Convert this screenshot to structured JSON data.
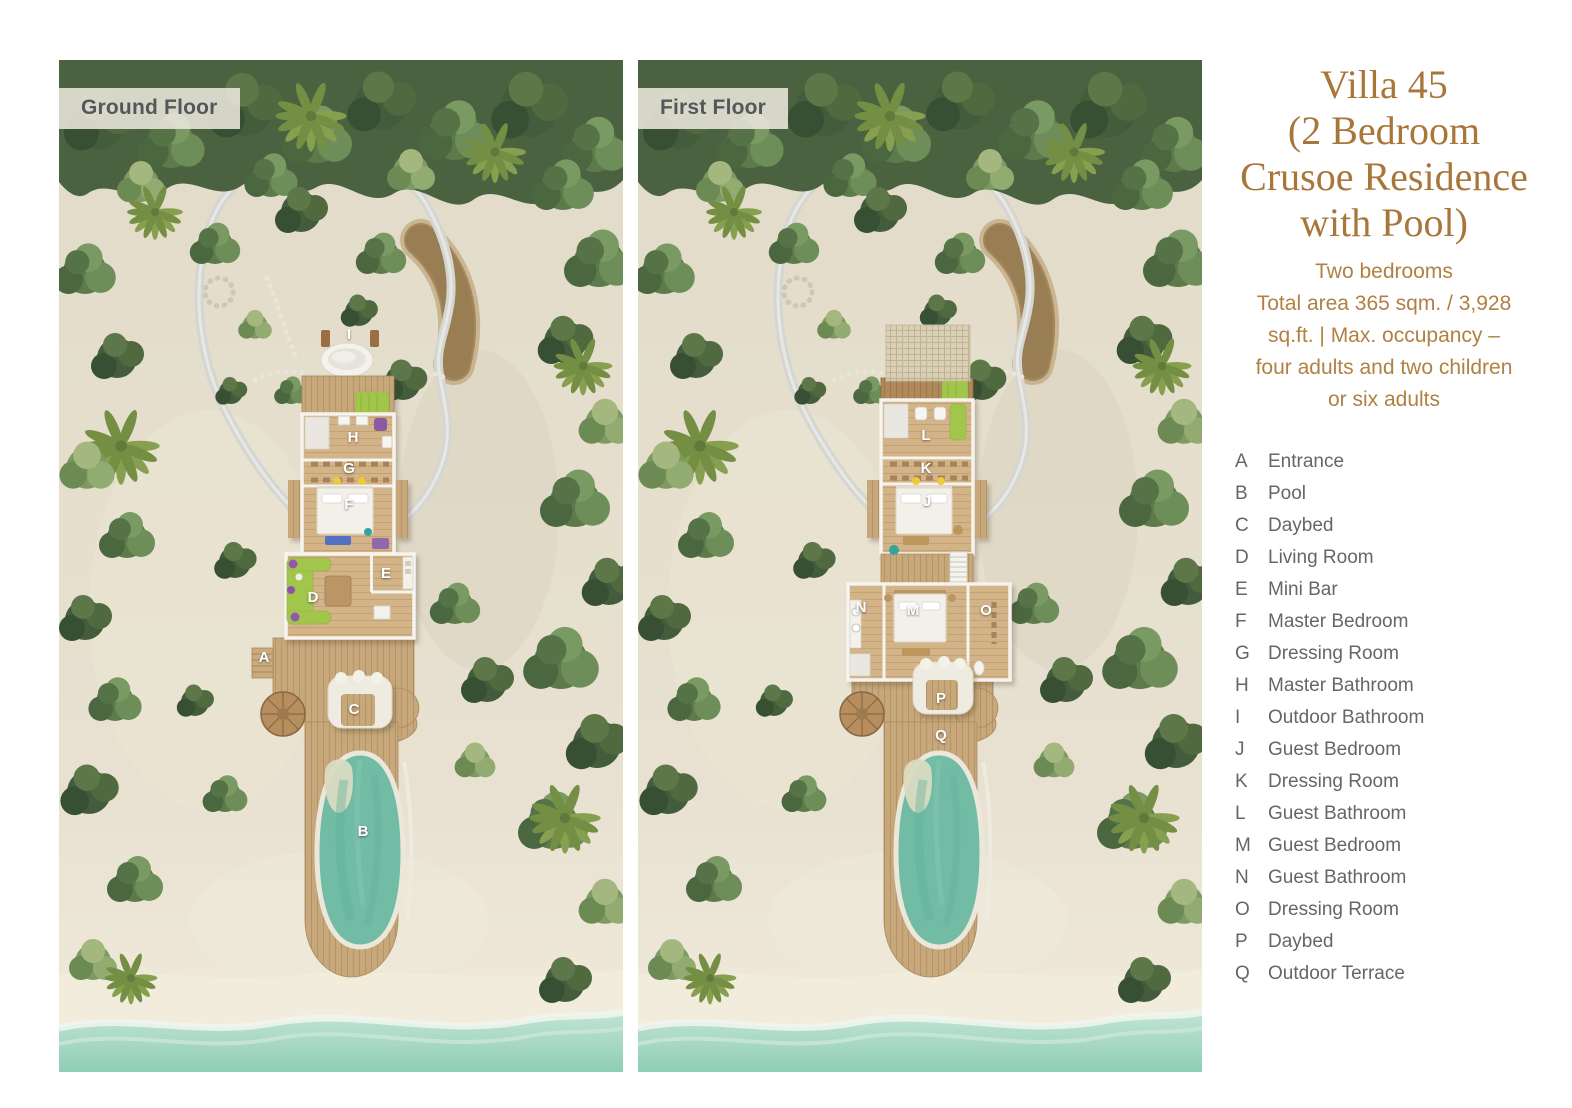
{
  "panels": [
    {
      "floor_label": "Ground Floor",
      "markers": [
        {
          "letter": "I",
          "x": 290,
          "y": 274
        },
        {
          "letter": "H",
          "x": 294,
          "y": 377
        },
        {
          "letter": "G",
          "x": 290,
          "y": 408
        },
        {
          "letter": "F",
          "x": 290,
          "y": 444
        },
        {
          "letter": "E",
          "x": 327,
          "y": 513
        },
        {
          "letter": "D",
          "x": 254,
          "y": 537
        },
        {
          "letter": "A",
          "x": 205,
          "y": 597
        },
        {
          "letter": "C",
          "x": 295,
          "y": 649
        },
        {
          "letter": "B",
          "x": 304,
          "y": 771
        }
      ]
    },
    {
      "floor_label": "First Floor",
      "markers": [
        {
          "letter": "L",
          "x": 288,
          "y": 375
        },
        {
          "letter": "K",
          "x": 288,
          "y": 408
        },
        {
          "letter": "J",
          "x": 289,
          "y": 441
        },
        {
          "letter": "N",
          "x": 223,
          "y": 547
        },
        {
          "letter": "M",
          "x": 275,
          "y": 550
        },
        {
          "letter": "O",
          "x": 348,
          "y": 550
        },
        {
          "letter": "P",
          "x": 303,
          "y": 638
        },
        {
          "letter": "Q",
          "x": 303,
          "y": 675
        }
      ]
    }
  ],
  "sidebar": {
    "title_lines": [
      "Villa 45",
      "(2 Bedroom",
      "Crusoe Residence",
      "with Pool)"
    ],
    "summary_lines": [
      "Two bedrooms",
      "Total area 365 sqm. / 3,928",
      "sq.ft. | Max. occupancy –",
      "four adults and two children",
      "or six adults"
    ],
    "legend": [
      {
        "key": "A",
        "label": "Entrance"
      },
      {
        "key": "B",
        "label": "Pool"
      },
      {
        "key": "C",
        "label": "Daybed"
      },
      {
        "key": "D",
        "label": "Living Room"
      },
      {
        "key": "E",
        "label": "Mini Bar"
      },
      {
        "key": "F",
        "label": "Master Bedroom"
      },
      {
        "key": "G",
        "label": "Dressing Room"
      },
      {
        "key": "H",
        "label": "Master Bathroom"
      },
      {
        "key": "I",
        "label": "Outdoor Bathroom"
      },
      {
        "key": "J",
        "label": "Guest Bedroom"
      },
      {
        "key": "K",
        "label": "Dressing Room"
      },
      {
        "key": "L",
        "label": "Guest Bathroom"
      },
      {
        "key": "M",
        "label": "Guest Bedroom"
      },
      {
        "key": "N",
        "label": "Guest Bathroom"
      },
      {
        "key": "O",
        "label": "Dressing Room"
      },
      {
        "key": "P",
        "label": "Daybed"
      },
      {
        "key": "Q",
        "label": "Outdoor Terrace"
      }
    ]
  },
  "colors": {
    "accent_brown": "#a9763a",
    "summary_brown": "#b08142",
    "legend_text": "#63676a",
    "chip_text": "#56575b",
    "chip_bg": "#ece8de",
    "pool_water": "#74bda6",
    "ocean": "#9ad1bd",
    "sand": "#e4ddcb",
    "foliage": "#4a6240",
    "deck_wood": "#c7a87a",
    "wall_white": "#d5d6d2",
    "lime_furniture": "#a2c64b"
  }
}
